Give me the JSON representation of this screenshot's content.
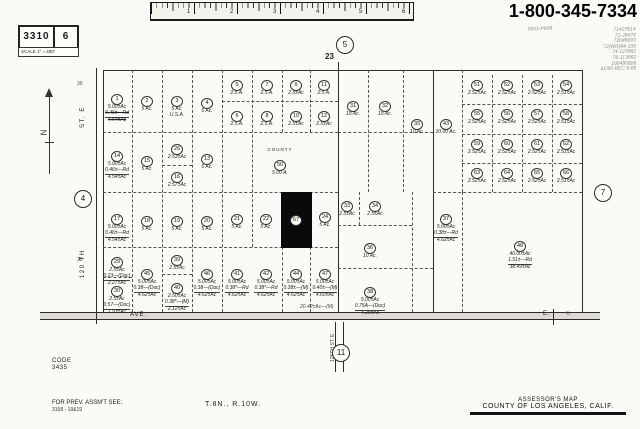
{
  "header": {
    "phone": "1-800-345-7334",
    "sheet_number": "3310",
    "page_number": "6",
    "scale_label": "SCALE 1\" = 400'",
    "handwritten_note": "8811-P608",
    "handwritten_column": [
      "71427614",
      "71-J9476",
      "72048093",
      "72(WR)84-109",
      "74-123862",
      "76-113862",
      "100490806",
      "81/90 REC 6-85"
    ],
    "ruler_numbers": [
      "1",
      "2",
      "3",
      "4",
      "5",
      "6"
    ]
  },
  "footer": {
    "code_label": "CODE",
    "code_value": "3435",
    "prev_assmt_label": "FOR PREV. ASSM'T SEE:",
    "prev_assmt_value": "3158 - 19&19",
    "township": "T.8N., R.10W.",
    "map_title": "ASSESSOR'S MAP",
    "map_subtitle": "COUNTY OF LOS ANGELES, CALIF."
  },
  "map": {
    "section_number": "23",
    "adjacent_sheets": {
      "top": "5",
      "left": "4",
      "right": "7",
      "bottom": "11"
    },
    "labels": [
      {
        "t": "ST.  E",
        "x": 80,
        "y": 128,
        "cls": "rot"
      },
      {
        "t": "120 TH",
        "x": 80,
        "y": 278,
        "cls": "rot"
      },
      {
        "t": "125TH  ST. E",
        "x": 330,
        "y": 362,
        "cls": "rot tiny"
      },
      {
        "t": "AVE.",
        "x": 130,
        "y": 312
      },
      {
        "t": "E.",
        "x": 543,
        "y": 311
      },
      {
        "t": "¾",
        "x": 566,
        "y": 311,
        "cls": "tiny"
      },
      {
        "t": "23",
        "x": 325,
        "y": 52,
        "cls": "sec"
      },
      {
        "t": "30",
        "x": 77,
        "y": 81,
        "cls": "tiny"
      },
      {
        "t": "30",
        "x": 77,
        "y": 257,
        "cls": "tiny"
      },
      {
        "t": "20.42±Ac—(M)",
        "x": 300,
        "y": 304,
        "cls": "tiny-i"
      }
    ],
    "lines": [
      [
        103,
        70,
        479,
        "h",
        "s"
      ],
      [
        96,
        68,
        256,
        "v",
        "s"
      ],
      [
        103,
        70,
        242,
        "v",
        "s"
      ],
      [
        582,
        70,
        242,
        "v",
        "s"
      ],
      [
        338,
        62,
        250,
        "v",
        "s"
      ],
      [
        433,
        70,
        242,
        "v",
        "s"
      ],
      [
        40,
        312,
        560,
        "h",
        "s"
      ],
      [
        40,
        319,
        560,
        "h",
        "s"
      ],
      [
        335,
        322,
        50,
        "v",
        "s"
      ],
      [
        343,
        322,
        50,
        "v",
        "s"
      ],
      [
        553,
        309,
        16,
        "v",
        "s"
      ],
      [
        132,
        70,
        242,
        "v",
        "d"
      ],
      [
        162,
        70,
        242,
        "v",
        "d"
      ],
      [
        192,
        70,
        242,
        "v",
        "d"
      ],
      [
        222,
        70,
        242,
        "v",
        "d"
      ],
      [
        252,
        70,
        177,
        "v",
        "d"
      ],
      [
        282,
        70,
        62,
        "v",
        "d"
      ],
      [
        310,
        70,
        62,
        "v",
        "d"
      ],
      [
        222,
        101,
        116,
        "h",
        "d"
      ],
      [
        103,
        132,
        235,
        "h",
        "d"
      ],
      [
        103,
        192,
        235,
        "h",
        "d"
      ],
      [
        103,
        247,
        235,
        "h",
        "d"
      ],
      [
        103,
        277,
        29,
        "h",
        "d"
      ],
      [
        162,
        274,
        30,
        "h",
        "d"
      ],
      [
        162,
        165,
        30,
        "h",
        "d"
      ],
      [
        282,
        247,
        65,
        "v",
        "d"
      ],
      [
        310,
        247,
        65,
        "v",
        "d"
      ],
      [
        368,
        70,
        122,
        "v",
        "d"
      ],
      [
        403,
        70,
        122,
        "v",
        "d"
      ],
      [
        338,
        132,
        95,
        "h",
        "d"
      ],
      [
        359,
        192,
        33,
        "v",
        "d"
      ],
      [
        412,
        192,
        120,
        "v",
        "d"
      ],
      [
        338,
        225,
        74,
        "h",
        "d"
      ],
      [
        338,
        268,
        95,
        "h",
        "d"
      ],
      [
        462,
        70,
        122,
        "v",
        "d"
      ],
      [
        492,
        75,
        117,
        "v",
        "d"
      ],
      [
        522,
        75,
        117,
        "v",
        "d"
      ],
      [
        552,
        75,
        117,
        "v",
        "d"
      ],
      [
        462,
        104,
        120,
        "h",
        "d"
      ],
      [
        462,
        134,
        120,
        "h",
        "d"
      ],
      [
        462,
        163,
        120,
        "h",
        "d"
      ],
      [
        433,
        192,
        149,
        "h",
        "d"
      ],
      [
        462,
        192,
        120,
        "v",
        "d"
      ]
    ],
    "parcels": [
      {
        "n": "1",
        "x": 117,
        "y": 93,
        "a": [
          "5.00±Ac",
          "0.46±—Rd",
          "4.54±Ac"
        ],
        "strike": true
      },
      {
        "n": "2",
        "x": 147,
        "y": 95,
        "a": [
          "5 Ac."
        ]
      },
      {
        "n": "3",
        "x": 177,
        "y": 95,
        "a": [
          "5 Ac.",
          "U.S.A."
        ]
      },
      {
        "n": "4",
        "x": 207,
        "y": 97,
        "a": [
          "5 Ac."
        ]
      },
      {
        "n": "5",
        "x": 237,
        "y": 79,
        "a": [
          "2.5 A."
        ]
      },
      {
        "n": "7",
        "x": 267,
        "y": 79,
        "a": [
          "2.5 A."
        ]
      },
      {
        "n": "9",
        "x": 296,
        "y": 79,
        "a": [
          "2.5±Ac"
        ]
      },
      {
        "n": "11",
        "x": 324,
        "y": 79,
        "a": [
          "2.5 A."
        ]
      },
      {
        "n": "6",
        "x": 237,
        "y": 110,
        "a": [
          "2.5 A."
        ]
      },
      {
        "n": "8",
        "x": 267,
        "y": 110,
        "a": [
          "2.5 A."
        ]
      },
      {
        "n": "10",
        "x": 296,
        "y": 110,
        "a": [
          "2.5±Ac"
        ]
      },
      {
        "n": "12",
        "x": 324,
        "y": 110,
        "a": [
          "2.5±Ac"
        ]
      },
      {
        "n": "14",
        "x": 117,
        "y": 150,
        "a": [
          "5.00±Ac",
          "0.46±—Rd",
          "4.54±Ac"
        ]
      },
      {
        "n": "15",
        "x": 147,
        "y": 155,
        "a": [
          "5 Ac."
        ]
      },
      {
        "n": "26",
        "x": 177,
        "y": 143,
        "a": [
          "2.53±Ac"
        ]
      },
      {
        "n": "16",
        "x": 177,
        "y": 171,
        "a": [
          "2.57±Ac"
        ]
      },
      {
        "n": "13",
        "x": 207,
        "y": 153,
        "a": [
          "5 Ac."
        ]
      },
      {
        "n": "50",
        "x": 280,
        "y": 153,
        "a": [
          "5.00 A."
        ],
        "hdr": "COUNTY"
      },
      {
        "n": "17",
        "x": 117,
        "y": 213,
        "a": [
          "5.00±Ac",
          "0.46±—Rd",
          "4.54±Ac"
        ]
      },
      {
        "n": "18",
        "x": 147,
        "y": 215,
        "a": [
          "5 Ac."
        ]
      },
      {
        "n": "19",
        "x": 177,
        "y": 215,
        "a": [
          "5 Ac."
        ]
      },
      {
        "n": "20",
        "x": 207,
        "y": 215,
        "a": [
          "5 Ac."
        ]
      },
      {
        "n": "21",
        "x": 237,
        "y": 213,
        "a": [
          "5 Ac."
        ]
      },
      {
        "n": "22",
        "x": 266,
        "y": 213,
        "a": [
          "5 Ac."
        ]
      },
      {
        "n": "67",
        "x": 296,
        "y": 214,
        "a": [],
        "blackRect": [
          281,
          192,
          31,
          56
        ]
      },
      {
        "n": "24",
        "x": 325,
        "y": 211,
        "a": [
          "5 Ac."
        ]
      },
      {
        "n": "29",
        "x": 117,
        "y": 256,
        "a": [
          "2.5±Ac",
          "0.23—(Doc)",
          "2.27±Ac"
        ]
      },
      {
        "n": "30",
        "x": 117,
        "y": 285,
        "a": [
          "2.5±Ac",
          "0.57—(Doc)",
          "1.93±Ac"
        ]
      },
      {
        "n": "45",
        "x": 147,
        "y": 268,
        "a": [
          "5.00±Ac",
          "0.38—(Doc)",
          "4.62±Ac"
        ]
      },
      {
        "n": "39",
        "x": 177,
        "y": 254,
        "a": [
          "2.5±Ac"
        ]
      },
      {
        "n": "40",
        "x": 177,
        "y": 282,
        "a": [
          "2.50±Ac",
          "0.38*—(M)",
          "2.12±Ac"
        ]
      },
      {
        "n": "46",
        "x": 207,
        "y": 268,
        "a": [
          "5.00±Ac",
          "0.38—(Doc)",
          "4.62±Ac"
        ]
      },
      {
        "n": "41",
        "x": 237,
        "y": 268,
        "a": [
          "5.00±Ac",
          "0.38*—Rd",
          "4.62±Ac"
        ]
      },
      {
        "n": "42",
        "x": 266,
        "y": 268,
        "a": [
          "5.00±Ac",
          "0.38*—Rd",
          "4.62±Ac"
        ]
      },
      {
        "n": "44",
        "x": 296,
        "y": 268,
        "a": [
          "5.00±Ac",
          "0.38±—(M)",
          "4.62±Ac"
        ]
      },
      {
        "n": "47",
        "x": 325,
        "y": 268,
        "a": [
          "5.00±Ac",
          "0.40±—(M)",
          "4.60±Ac"
        ]
      },
      {
        "n": "31",
        "x": 353,
        "y": 100,
        "a": [
          "10 Ac."
        ]
      },
      {
        "n": "32",
        "x": 385,
        "y": 100,
        "a": [
          "10 Ac."
        ]
      },
      {
        "n": "35",
        "x": 417,
        "y": 118,
        "a": [
          "10 Ac."
        ]
      },
      {
        "n": "33",
        "x": 347,
        "y": 200,
        "a": [
          "2.5±Ac"
        ]
      },
      {
        "n": "34",
        "x": 375,
        "y": 200,
        "a": [
          "2.5±Ac"
        ]
      },
      {
        "n": "36",
        "x": 370,
        "y": 242,
        "a": [
          "10 Ac."
        ]
      },
      {
        "n": "38",
        "x": 370,
        "y": 286,
        "a": [
          "5.00±Ac",
          "0.75A—(Doc)",
          "4.25±Ac"
        ]
      },
      {
        "n": "43",
        "x": 446,
        "y": 118,
        "a": [
          "10.00 Ac."
        ]
      },
      {
        "n": "51",
        "x": 477,
        "y": 79,
        "a": [
          "2.52±Ac"
        ]
      },
      {
        "n": "52",
        "x": 507,
        "y": 79,
        "a": [
          "2.52±Ac"
        ]
      },
      {
        "n": "53",
        "x": 537,
        "y": 79,
        "a": [
          "2.52±Ac"
        ]
      },
      {
        "n": "54",
        "x": 566,
        "y": 79,
        "a": [
          "2.51±Ac"
        ]
      },
      {
        "n": "55",
        "x": 477,
        "y": 108,
        "a": [
          "2.52±Ac"
        ]
      },
      {
        "n": "56",
        "x": 507,
        "y": 108,
        "a": [
          "2.52±Ac"
        ]
      },
      {
        "n": "57",
        "x": 537,
        "y": 108,
        "a": [
          "2.52±Ac"
        ]
      },
      {
        "n": "58",
        "x": 566,
        "y": 108,
        "a": [
          "2.51±Ac"
        ]
      },
      {
        "n": "59",
        "x": 477,
        "y": 138,
        "a": [
          "2.52±Ac"
        ]
      },
      {
        "n": "60",
        "x": 507,
        "y": 138,
        "a": [
          "2.52±Ac"
        ]
      },
      {
        "n": "61",
        "x": 537,
        "y": 138,
        "a": [
          "2.52±Ac"
        ]
      },
      {
        "n": "62",
        "x": 566,
        "y": 138,
        "a": [
          "2.51±Ac"
        ]
      },
      {
        "n": "63",
        "x": 477,
        "y": 167,
        "a": [
          "2.52±Ac"
        ]
      },
      {
        "n": "64",
        "x": 507,
        "y": 167,
        "a": [
          "2.52±Ac"
        ]
      },
      {
        "n": "65",
        "x": 537,
        "y": 167,
        "a": [
          "2.52±Ac"
        ]
      },
      {
        "n": "66",
        "x": 566,
        "y": 167,
        "a": [
          "2.51±Ac"
        ]
      },
      {
        "n": "37",
        "x": 446,
        "y": 213,
        "a": [
          "5.00±Ac",
          "0.38±—Rd",
          "4.62±Ac"
        ]
      },
      {
        "n": "48",
        "x": 520,
        "y": 240,
        "a": [
          "40.00±Ac",
          "1.51±—Rd",
          "38.49±Ac"
        ]
      }
    ]
  }
}
